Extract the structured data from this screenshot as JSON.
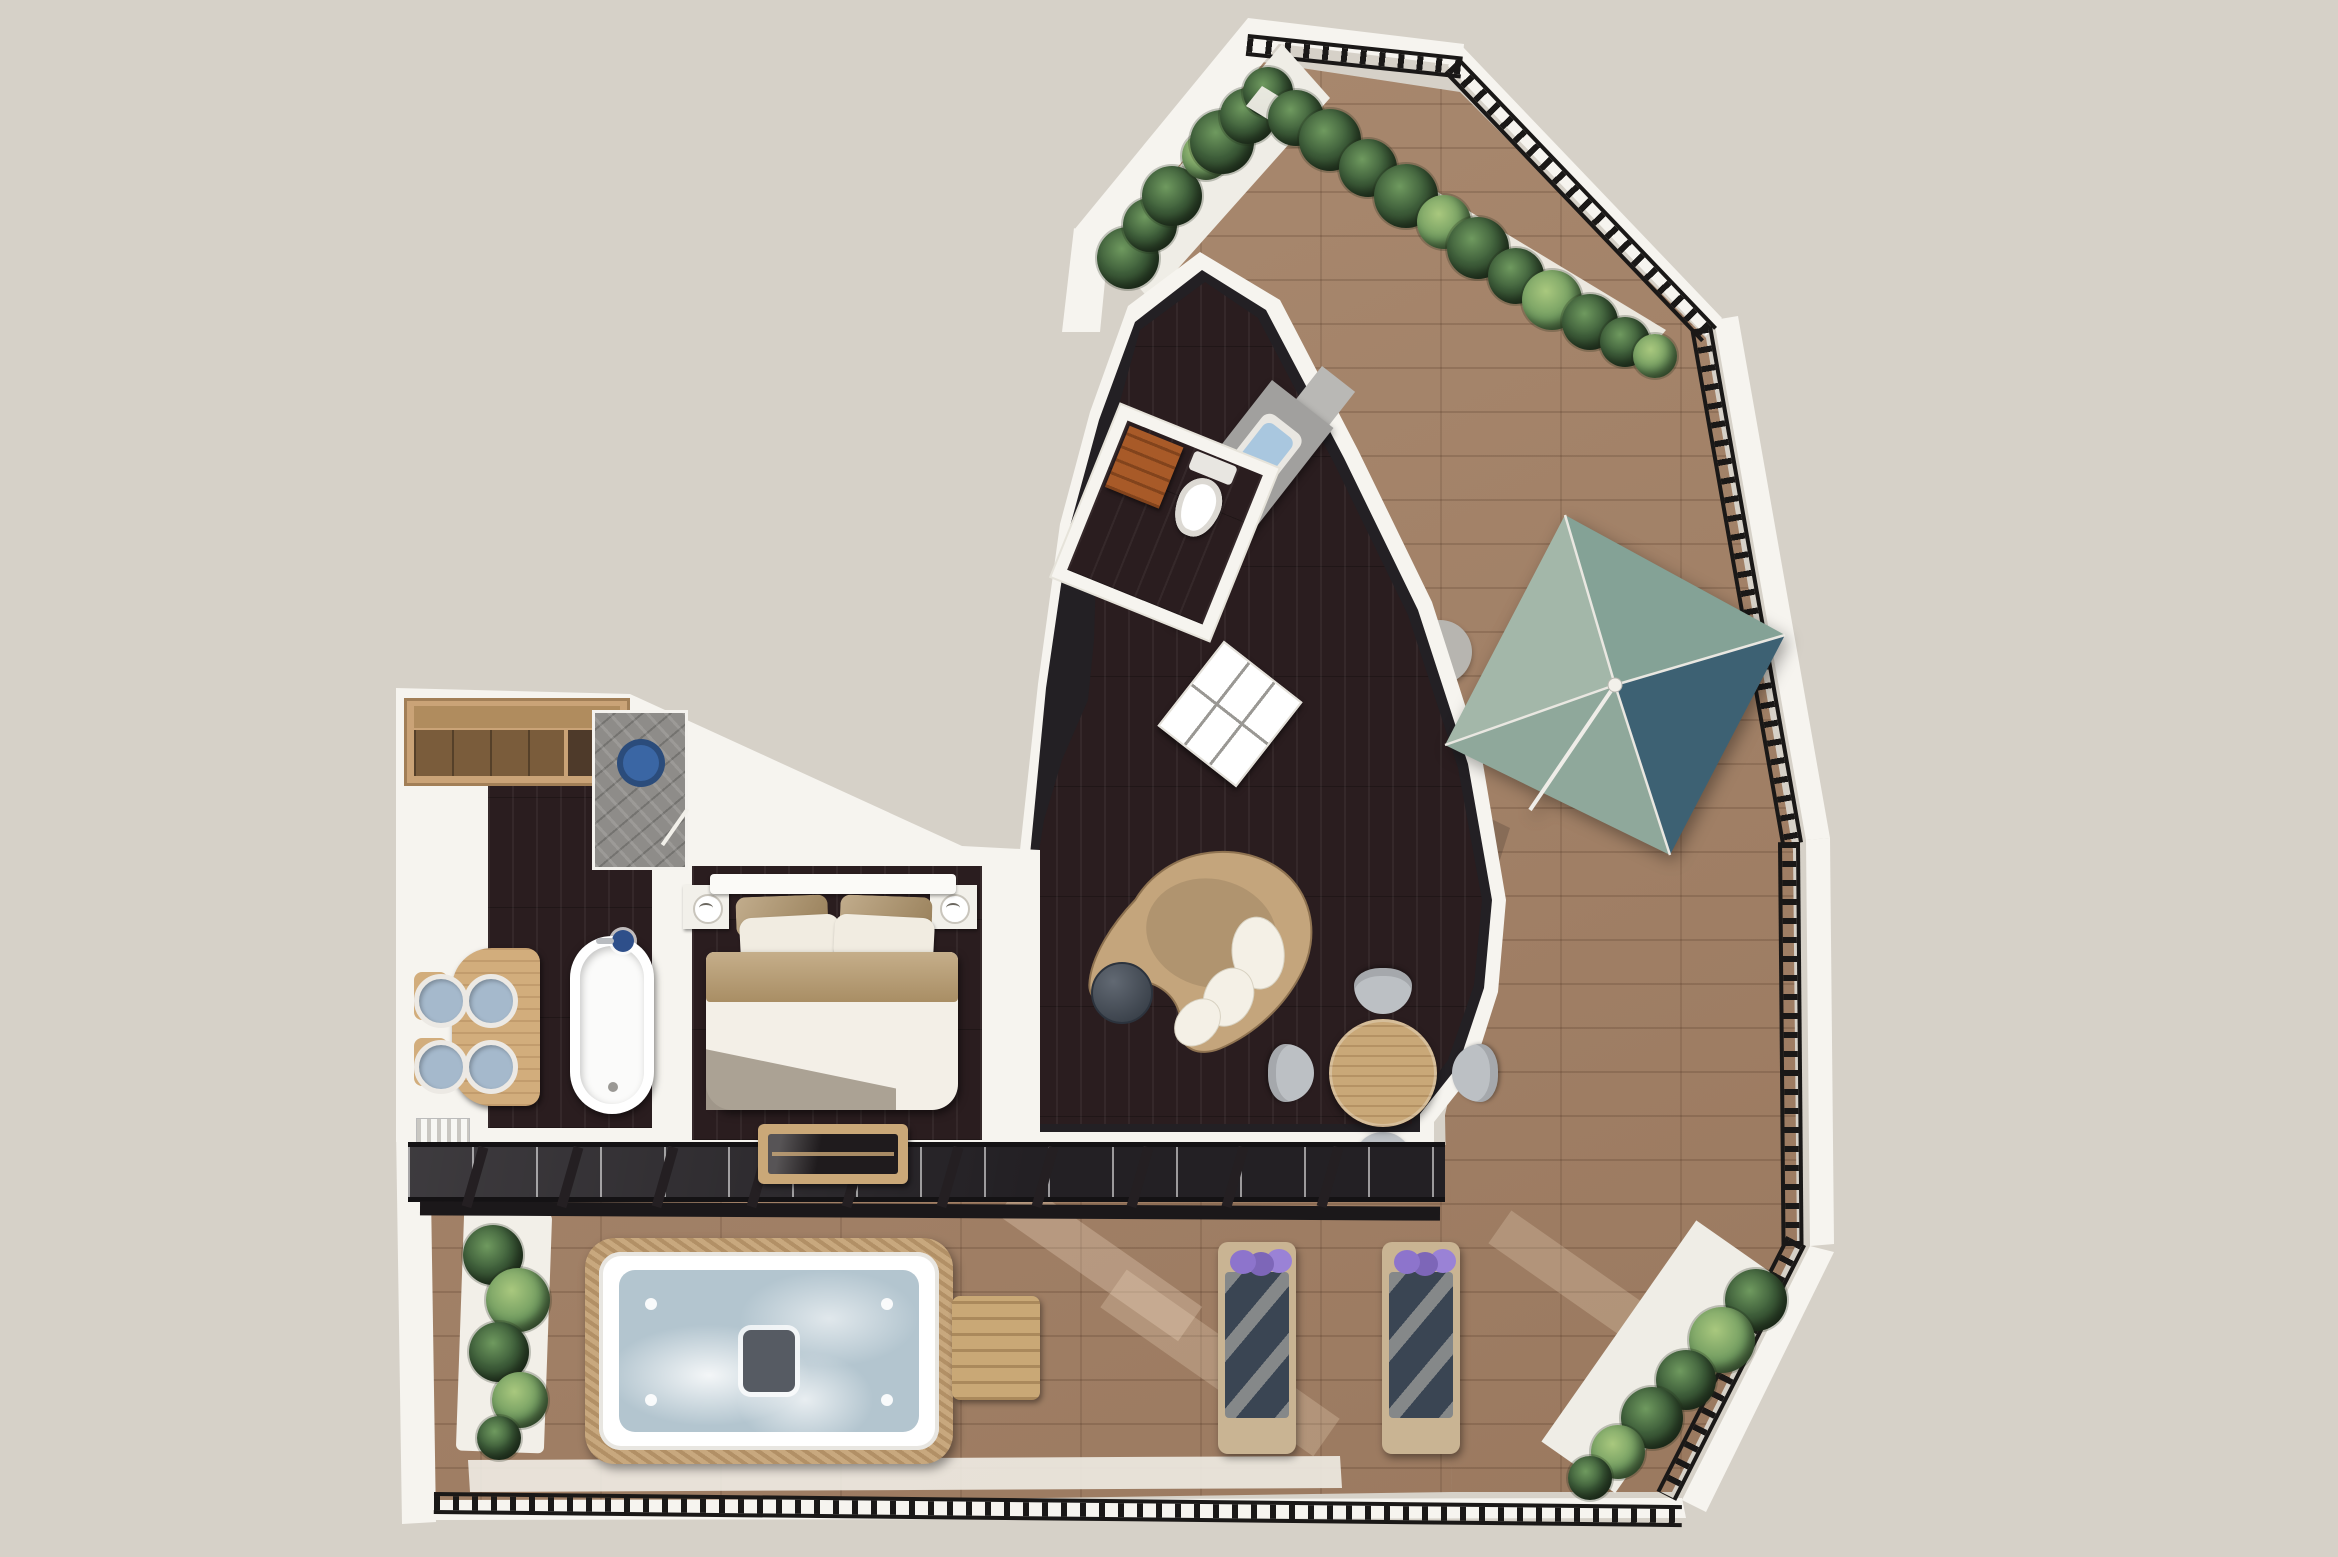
{
  "scene": {
    "name": "penthouse-suite-3d-floor-plan",
    "view": "top-down 3D architectural render",
    "background": "#d6d1c8"
  },
  "palette": {
    "background": "#d6d1c8",
    "wall": "#f6f4ef",
    "terrace_tile": "#a17f64",
    "interior_floor": "#2a1d1f",
    "railing": "#1a1817",
    "glass_band": "#232024",
    "pergola_beam": "#1b181a",
    "planter_box": "#efede6",
    "plant_dark": "#3e5e3a",
    "plant_light": "#6f9a5f",
    "umbrella_panel_nw": "#a3b7a9",
    "umbrella_panel_ne": "#84a296",
    "umbrella_panel_se": "#3d6173",
    "umbrella_panel_sw": "#8fa89b",
    "sofa_body": "#c4a57c",
    "sofa_cushion": "#f4f0e6",
    "coffee_table": "#3f4854",
    "dining_table": "#c9a878",
    "dining_chair": "#bcc0c4",
    "kitchen_counter": "#a1a09e",
    "kitchen_back_wall": "#b9b8b5",
    "kitchen_sink": "#a9c7df",
    "cooktop": "#2c2c2f",
    "shelf_unit": "#ffffff",
    "wc_cabinet": "#a85a28",
    "toilet": "#ffffff",
    "wardrobe_wood": "#caa377",
    "shower_tile": "#8e8c89",
    "shower_head_blue": "#3a66a4",
    "vanity_wood": "#d2ad7c",
    "sink_basin": "#a5b9cc",
    "bathtub": "#ffffff",
    "tub_faucet_navy": "#2e4f8a",
    "radiator": "#f7f7f4",
    "bed_duvet": "#f3efe7",
    "bed_blanket": "#b79a6d",
    "bed_pillow_tan": "#ad9166",
    "bed_pillow_white": "#f1ece1",
    "bed_throw": "#a79d8f",
    "headboard": "#fbfaf7",
    "bench_wood": "#caa878",
    "bench_glass": "#1f1b1d",
    "jacuzzi_shell": "#ffffff",
    "jacuzzi_water": "#b3c5cf",
    "jacuzzi_wicker": "#c8a87e",
    "side_table_wood": "#c9a876",
    "lounger_frame": "#c9b493",
    "lounger_mat": "#3a4553",
    "lounger_flowers": "#8d74cc",
    "terrace_ledge": "#efece4"
  },
  "rooms": [
    {
      "id": "terrace",
      "label": "Wrap-around tiled terrace",
      "features": [
        "black perimeter railing",
        "planter boxes with shrubs",
        "square four-panel parasol",
        "parasol side table"
      ]
    },
    {
      "id": "living-room",
      "label": "Living room",
      "features": [
        "kidney-shaped sofa with white cushions",
        "round dark coffee table",
        "round dining table with four grey chairs",
        "white open shelf unit"
      ]
    },
    {
      "id": "kitchen",
      "label": "Kitchenette",
      "features": [
        "angled counter",
        "inset sink",
        "dark cooktop"
      ]
    },
    {
      "id": "wc",
      "label": "Guest WC",
      "features": [
        "toilet",
        "orange wood cabinet"
      ]
    },
    {
      "id": "bathroom",
      "label": "Bathroom",
      "features": [
        "wardrobe",
        "walk-in shower with blue rain head",
        "wood vanity with four round basins",
        "freestanding oval bathtub",
        "towel radiator"
      ]
    },
    {
      "id": "bedroom",
      "label": "Bedroom",
      "features": [
        "double bed with tan and white pillows",
        "two nightstands",
        "foot-of-bed bench with glass shelf"
      ]
    },
    {
      "id": "spa-terrace",
      "label": "Lower spa terrace",
      "features": [
        "hot tub with wicker surround",
        "wooden side table",
        "two sun loungers with purple flowers",
        "pergola beams",
        "planters"
      ]
    }
  ]
}
